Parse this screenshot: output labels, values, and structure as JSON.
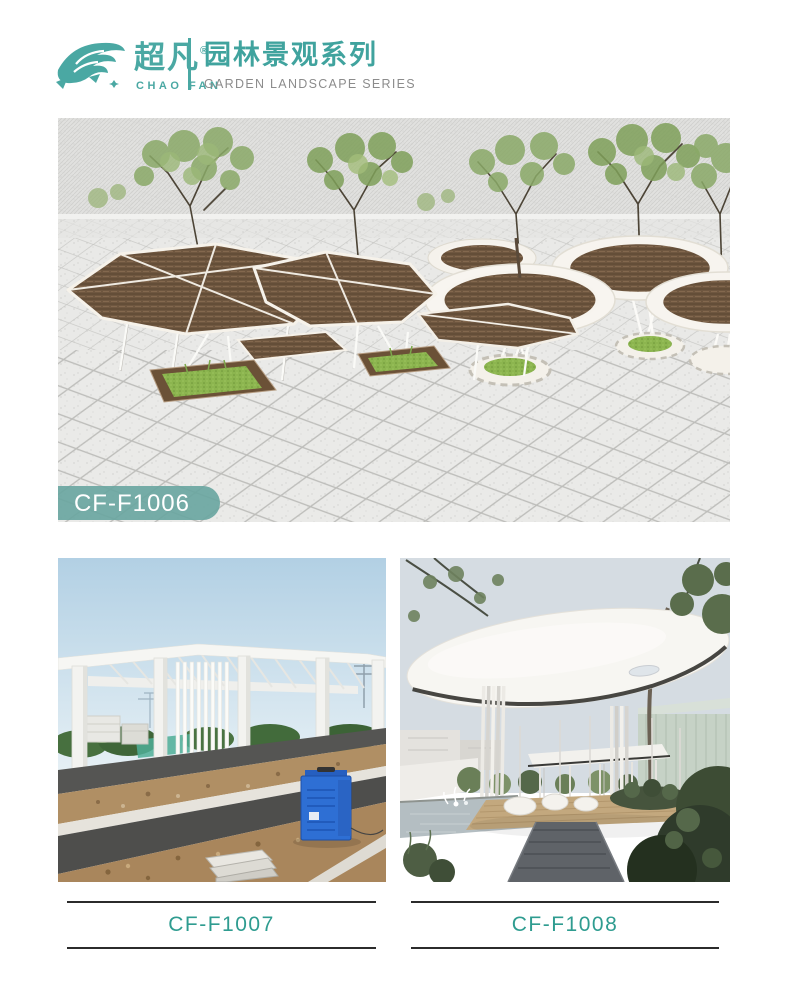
{
  "header": {
    "logo": {
      "cn": "超凡",
      "reg": "®",
      "en": "CHAO FAN"
    },
    "series": {
      "cn": "园林景观系列",
      "en": "GARDEN LANDSCAPE SERIES"
    }
  },
  "colors": {
    "accent_teal": "#4AA8A3",
    "label_teal": "#2F9C90",
    "series_en_gray": "#8C8C8C",
    "label_line": "#2B2B2B",
    "badge_teal": "#68A5A0",
    "weave_brown": "#6F5740",
    "grass_green": "#8CB54F"
  },
  "products": [
    {
      "code": "CF-F1006"
    },
    {
      "code": "CF-F1007"
    },
    {
      "code": "CF-F1008"
    }
  ]
}
